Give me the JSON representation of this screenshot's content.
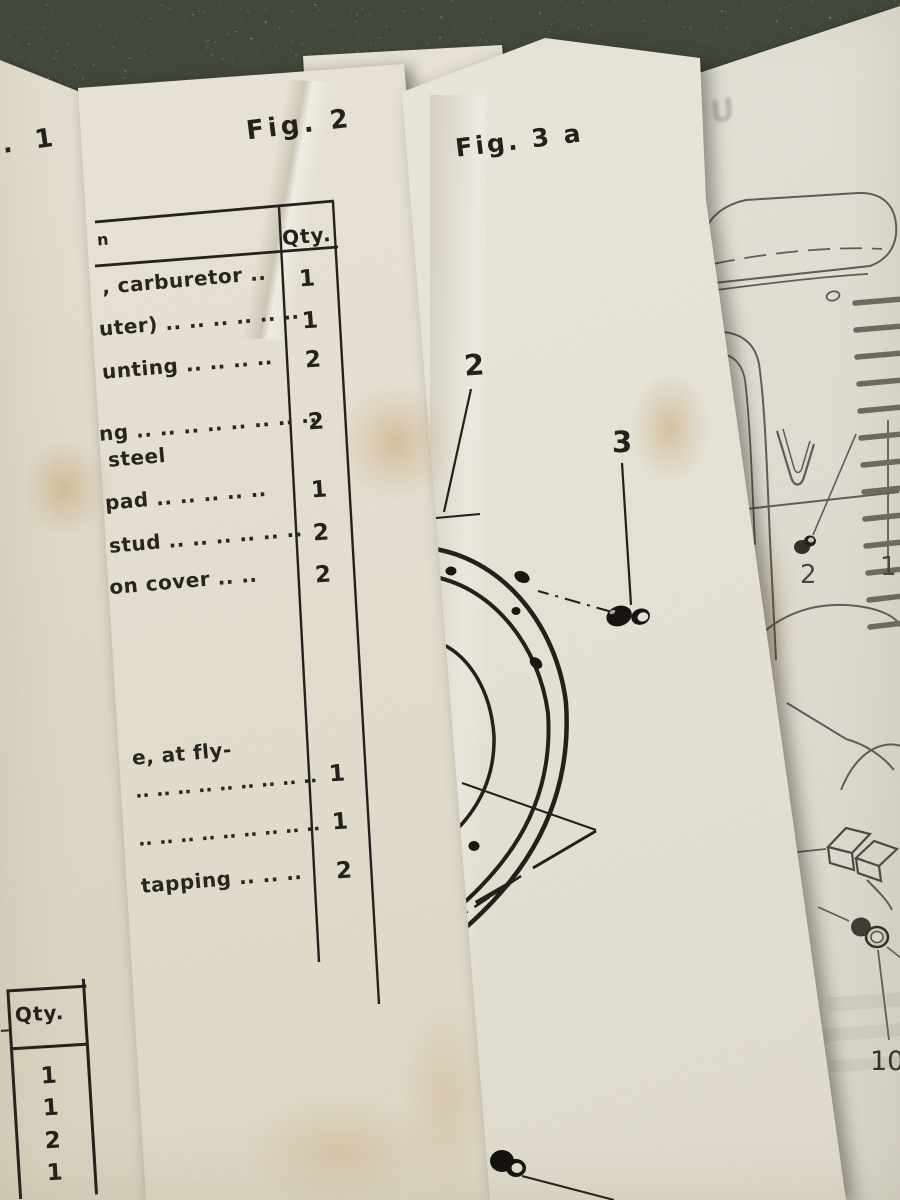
{
  "pages": {
    "fig1_page": {
      "title_fragment": ". 1",
      "qty_table": {
        "header": "Qty.",
        "values": [
          "1",
          "1",
          "2",
          "1"
        ]
      }
    },
    "fig2_page": {
      "title": "Fig. 2",
      "table": {
        "desc_header_fragment": "n",
        "qty_header": "Qty.",
        "rows": [
          {
            "desc": ", carburetor ..",
            "qty": "1"
          },
          {
            "desc": "uter) .. .. .. .. .. ..",
            "qty": "1"
          },
          {
            "desc": "unting .. .. .. ..",
            "qty": "2"
          },
          {
            "desc": "ng .. .. .. .. .. .. .. ..",
            "desc2": "steel",
            "qty": "2"
          },
          {
            "desc": "pad .. .. .. .. ..",
            "qty": "1"
          },
          {
            "desc": "stud .. .. .. .. .. ..",
            "qty": "2"
          },
          {
            "desc": "ion cover .. ..",
            "qty": "2"
          },
          {
            "desc": "e, at fly-",
            "desc2": ".. .. .. .. .. .. .. .. ..",
            "qty": "1"
          },
          {
            "desc": ".. .. .. .. .. .. .. .. ..",
            "qty": "1"
          },
          {
            "desc": "tapping .. .. ..",
            "qty": "2"
          }
        ]
      }
    },
    "fig3a_page": {
      "title": "Fig. 3 a",
      "callout_2": "2",
      "callout_3": "3"
    },
    "fig3_page": {
      "ghost_text": "FU",
      "callout_2": "2",
      "callout_1": "1",
      "callout_10": "10"
    }
  }
}
